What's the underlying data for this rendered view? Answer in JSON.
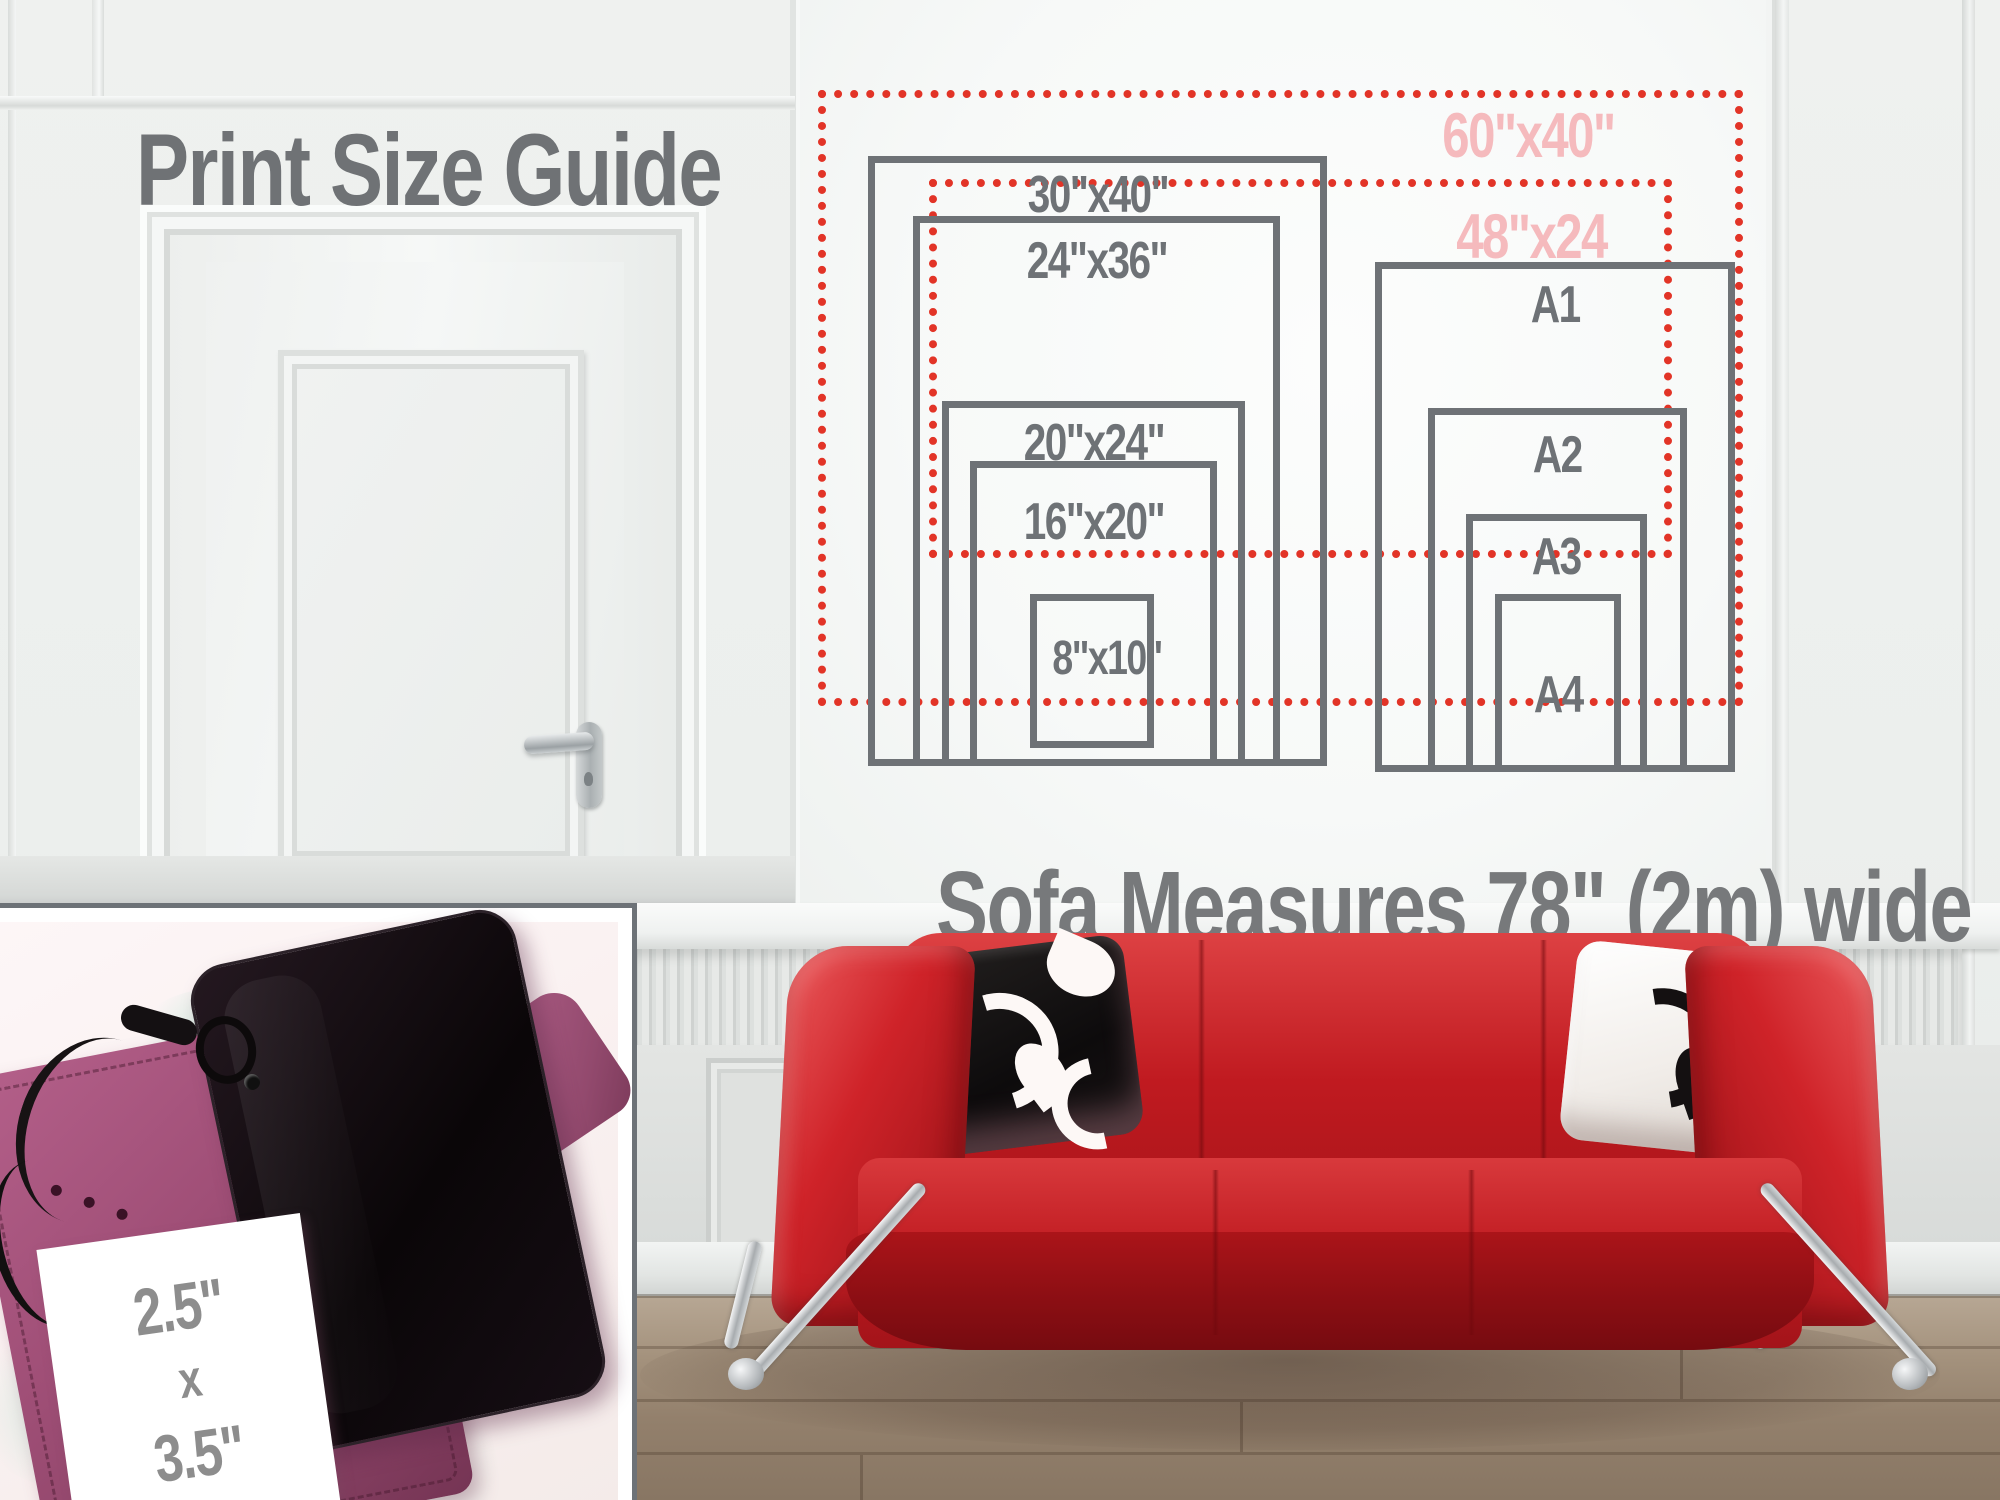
{
  "title": "Print Size Guide",
  "caption": "Sofa Measures 78\" (2m) wide",
  "guide": {
    "imperial": [
      {
        "label": "30\"x40\""
      },
      {
        "label": "24\"x36\""
      },
      {
        "label": "20\"x24\""
      },
      {
        "label": "16\"x20\""
      },
      {
        "label": "8\"x10\""
      }
    ],
    "oversize": [
      {
        "label": "60\"x40\""
      },
      {
        "label": "48\"x24"
      }
    ],
    "a_series": [
      {
        "label": "A1"
      },
      {
        "label": "A2"
      },
      {
        "label": "A3"
      },
      {
        "label": "A4"
      }
    ]
  },
  "inset_card": {
    "line1": "2.5\"",
    "line2": "x",
    "line3": "3.5\""
  },
  "colors": {
    "dashed_red": "#e23427",
    "pink_label": "#f5babd",
    "gray_label": "#6e7276",
    "sofa_red": "#c2181f",
    "wallet_plum": "#9d4b73"
  }
}
